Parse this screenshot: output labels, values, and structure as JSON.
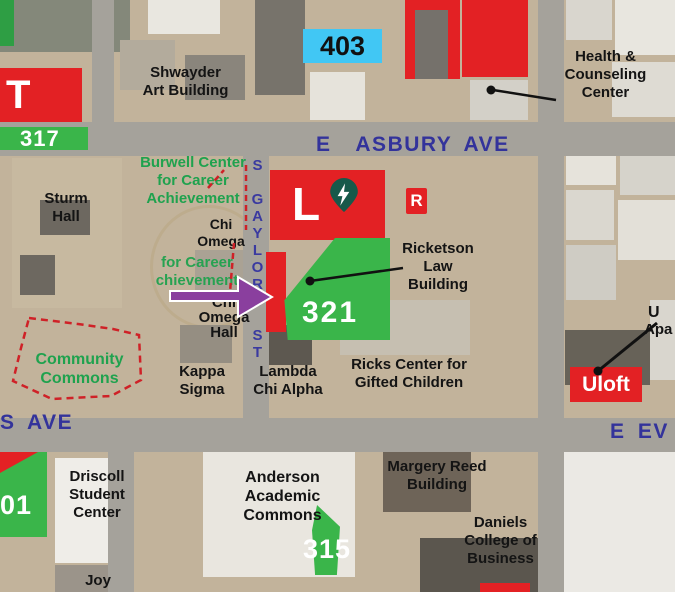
{
  "streets": {
    "asbury": "E  ASBURY AVE",
    "gaylord": "S GAYLORD ST",
    "evans_left": "S AVE",
    "evans_right": "E EV"
  },
  "parking_lots": {
    "lot_t": "T",
    "lot_317": "317",
    "lot_403": "403",
    "lot_321": "321",
    "lot_315": "315",
    "lot_01": "01"
  },
  "markers": {
    "l_building": "L",
    "r_marker": "R",
    "uloft": "Uloft",
    "uloft_ref_line1": "U",
    "uloft_ref_line2": "Apa"
  },
  "labels": {
    "shwayder": "Shwayder\nArt Building",
    "health": "Health &\nCounseling\nCenter",
    "burwell": "Burwell Center\nfor Career\nAchievement",
    "burwell_ghost": "for Career\nchievement",
    "sturm": "Sturm\nHall",
    "chi_omega": "Chi\nOmega",
    "chi_omega_hall": "Chi\nOmega\nHall",
    "ricketson": "Ricketson\nLaw\nBuilding",
    "community_commons": "Community\nCommons",
    "kappa_sigma": "Kappa\nSigma",
    "lambda_chi": "Lambda\nChi Alpha",
    "ricks": "Ricks Center for\nGifted Children",
    "driscoll": "Driscoll\nStudent\nCenter",
    "anderson": "Anderson\nAcademic\nCommons",
    "margery": "Margery Reed\nBuilding",
    "daniels": "Daniels\nCollege of\nBusiness",
    "joy": "Joy"
  },
  "colors": {
    "overlay_red": "#e32124",
    "overlay_green": "#3ab54a",
    "lot_cyan": "#41c7f4",
    "street_blue": "#33339b",
    "label_green": "#1fa24e",
    "arrow_purple": "#8a3f9e",
    "ev_pin_green": "#17594a",
    "dash_red": "#cf2127"
  }
}
